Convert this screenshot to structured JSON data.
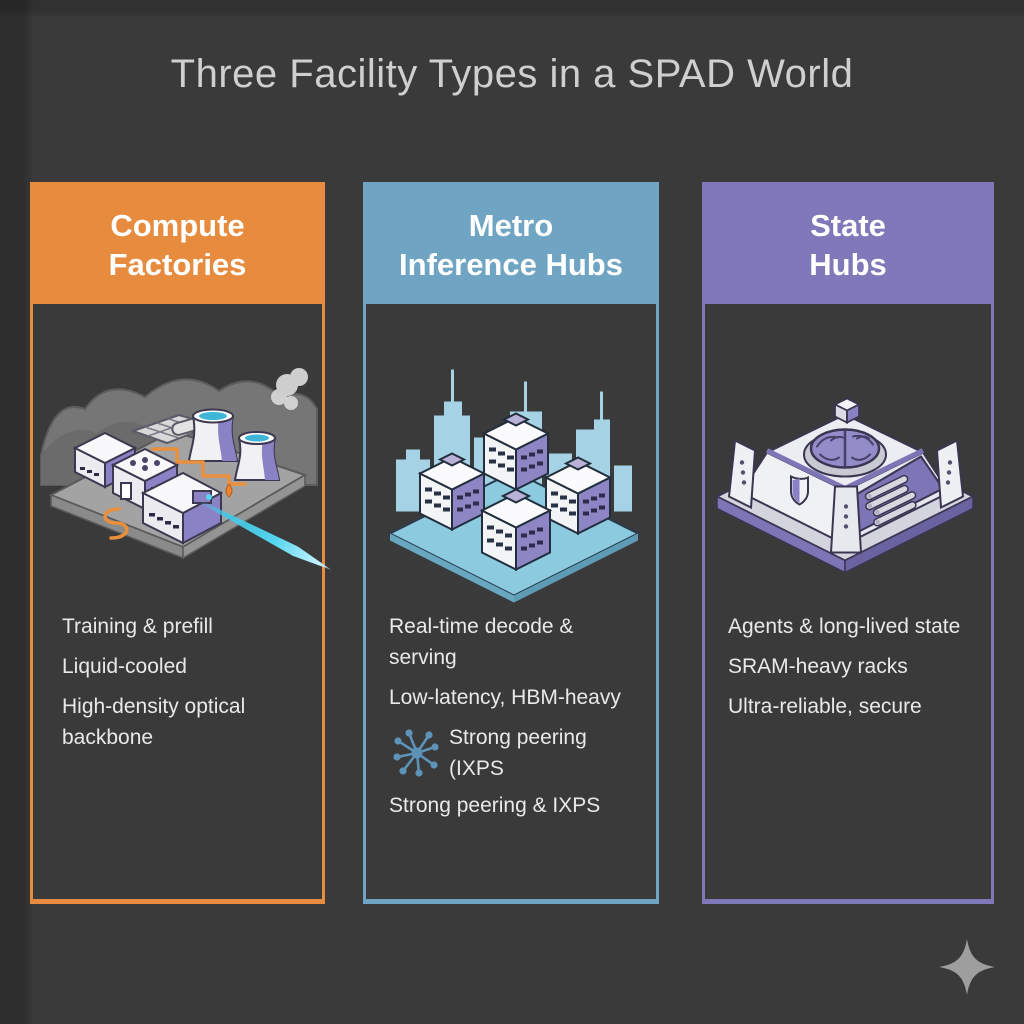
{
  "title": "Three Facility Types in a SPAD World",
  "columns": [
    {
      "id": "compute-factories",
      "header_line1": "Compute",
      "header_line2": "Factories",
      "accent": "#E78B3E",
      "bullets": [
        "Training & prefill",
        "Liquid-cooled",
        "High-density optical backbone"
      ],
      "illustration": "isometric compute factory with cooling towers, smoke and orange power lines"
    },
    {
      "id": "metro-inference-hubs",
      "header_line1": "Metro",
      "header_line2": "Inference Hubs",
      "accent": "#6FA4C2",
      "bullets": [
        "Real-time decode & serving",
        "Low-latency, HBM-heavy",
        "Strong peering (IXPS",
        "Strong peering & IXPS"
      ],
      "illustration": "isometric data-center buildings on a platform with city skyline"
    },
    {
      "id": "state-hubs",
      "header_line1": "State",
      "header_line2": "Hubs",
      "accent": "#7F78B9",
      "bullets": [
        "Agents & long-lived state",
        "SRAM-heavy racks",
        "Ultra-reliable, secure"
      ],
      "illustration": "isometric secure vault with brain, shield emblem and memory rack"
    }
  ],
  "icons": {
    "network_hub": "network-hub-icon",
    "sparkle": "sparkle-icon",
    "beam": "optical-beam"
  },
  "colors": {
    "background": "#3A3A3B",
    "title_text": "#CFCFCF",
    "bullet_text": "#E9E9E9",
    "beam": "#55D6F0"
  }
}
